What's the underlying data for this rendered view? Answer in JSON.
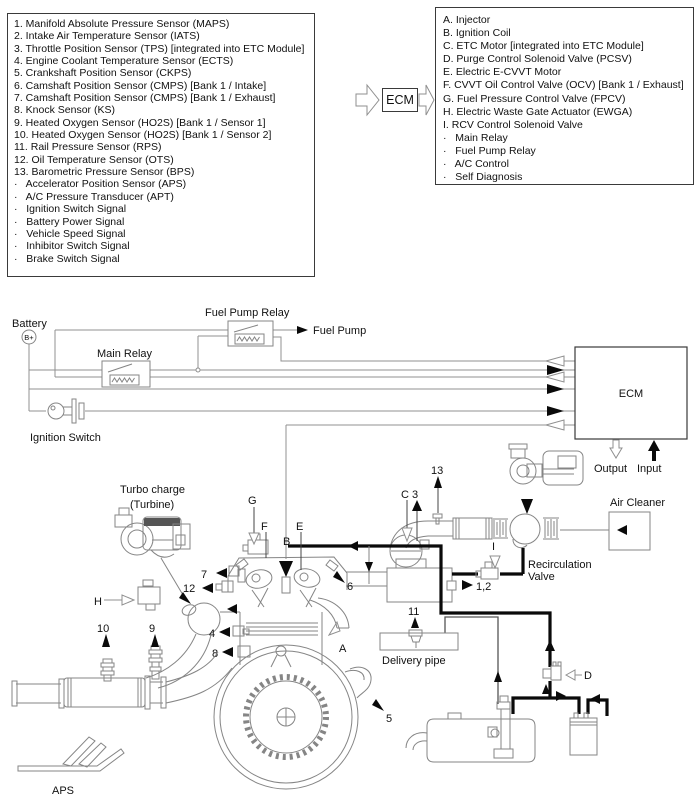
{
  "inputs_box": {
    "items": [
      "1. Manifold Absolute Pressure Sensor (MAPS)",
      "2. Intake Air Temperature Sensor (IATS)",
      "3. Throttle Position Sensor (TPS) [integrated into ETC Module]",
      "4. Engine Coolant Temperature Sensor (ECTS)",
      "5. Crankshaft Position Sensor (CKPS)",
      "6. Camshaft Position Sensor (CMPS) [Bank 1 / Intake]",
      "7. Camshaft Position Sensor (CMPS) [Bank 1 / Exhaust]",
      "8. Knock Sensor (KS)",
      "9. Heated Oxygen Sensor (HO2S) [Bank 1 / Sensor 1]",
      "10. Heated Oxygen Sensor (HO2S) [Bank 1 / Sensor 2]",
      "11. Rail Pressure Sensor (RPS)",
      "12. Oil Temperature Sensor (OTS)",
      "13. Barometric Pressure Sensor (BPS)",
      "·   Accelerator Position Sensor (APS)",
      "·   A/C Pressure Transducer (APT)",
      "·   Ignition Switch Signal",
      "·   Battery Power Signal",
      "·   Vehicle Speed Signal",
      "·   Inhibitor Switch Signal",
      "·   Brake Switch Signal"
    ]
  },
  "flow": {
    "ecm": "ECM"
  },
  "outputs_box": {
    "items": [
      "A. Injector",
      "B. Ignition Coil",
      "C. ETC Motor [integrated into ETC Module]",
      "D. Purge Control Solenoid Valve (PCSV)",
      "E. Electric E-CVVT Motor",
      "F. CVVT Oil Control Valve (OCV) [Bank 1 / Exhaust]",
      "G. Fuel Pressure Control Valve (FPCV)",
      "H. Electric Waste Gate Actuator (EWGA)",
      "I. RCV Control Solenoid Valve",
      "·   Main Relay",
      "·   Fuel Pump Relay",
      "·   A/C Control",
      "·   Self Diagnosis"
    ]
  },
  "diagram": {
    "battery": "Battery",
    "battery_terminal": "B+",
    "main_relay": "Main Relay",
    "fuel_pump_relay": "Fuel Pump Relay",
    "fuel_pump": "Fuel Pump",
    "ignition_switch": "Ignition Switch",
    "ecm": "ECM",
    "output": "Output",
    "input": "Input",
    "turbo_charge": "Turbo charge",
    "turbine": "(Turbine)",
    "air_cleaner": "Air Cleaner",
    "recirculation": "Recirculation",
    "valve": "Valve",
    "delivery_pipe": "Delivery pipe",
    "aps": "APS",
    "callouts": {
      "g": "G",
      "f": "F",
      "e": "E",
      "b": "B",
      "c3": "C 3",
      "n13": "13",
      "i": "I",
      "n1_2": "1,2",
      "n7": "7",
      "n12": "12",
      "h": "H",
      "n6": "6",
      "n10": "10",
      "n9": "9",
      "n4": "4",
      "n8": "8",
      "n11": "11",
      "a": "A",
      "n5": "5",
      "d": "D"
    },
    "colors": {
      "line_art": "#858585",
      "wire": "#909090",
      "ink": "#0a0a0a",
      "background": "#ffffff"
    }
  }
}
